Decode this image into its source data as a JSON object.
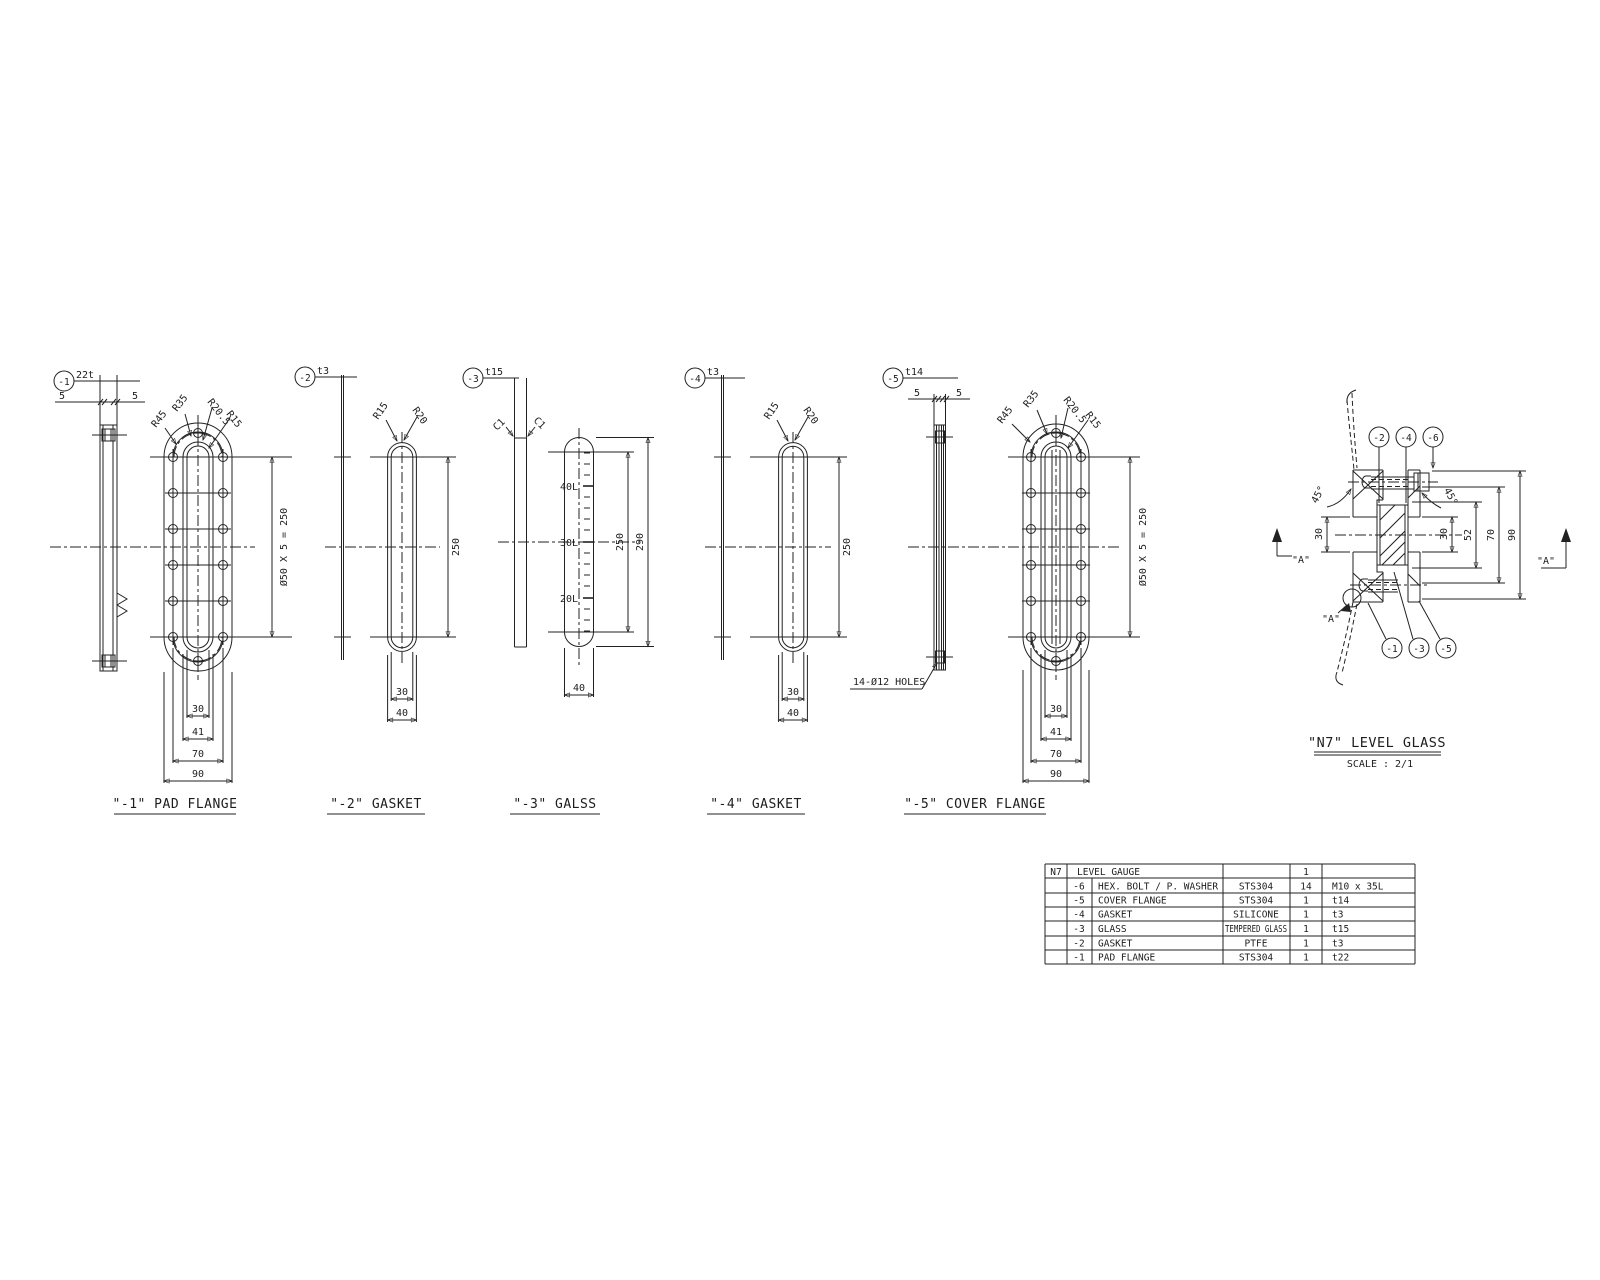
{
  "page": {
    "background": "#ffffff",
    "line_color": "#222222"
  },
  "views": {
    "v1": {
      "balloon": "-1",
      "thickness": "22t",
      "dim5a": "5",
      "dim5b": "5",
      "r45": "R45",
      "r35": "R35",
      "r205": "R20.5",
      "r15": "R15",
      "pitch": "Ø50 X 5 = 250",
      "d30": "30",
      "d41": "41",
      "d70": "70",
      "d90": "90",
      "title": "\"-1\" PAD FLANGE"
    },
    "v2": {
      "balloon": "-2",
      "thickness": "t3",
      "r15": "R15",
      "r20": "R20",
      "d250": "250",
      "d30": "30",
      "d40": "40",
      "title": "\"-2\" GASKET"
    },
    "v3": {
      "balloon": "-3",
      "thickness": "t15",
      "c1_left": "C1",
      "c1_right": "C1",
      "mark40": "40L",
      "mark30": "30L",
      "mark20": "20L",
      "d250": "250",
      "d290": "290",
      "d40": "40",
      "title": "\"-3\" GALSS"
    },
    "v4": {
      "balloon": "-4",
      "thickness": "t3",
      "r15": "R15",
      "r20": "R20",
      "d250": "250",
      "d30": "30",
      "d40": "40",
      "title": "\"-4\" GASKET"
    },
    "v5": {
      "balloon": "-5",
      "thickness": "t14",
      "dim5a": "5",
      "dim5b": "5",
      "r45": "R45",
      "r35": "R35",
      "r205": "R20.5",
      "r15": "R15",
      "pitch": "Ø50 X 5 = 250",
      "holes_note": "14-Ø12 HOLES",
      "d30": "30",
      "d41": "41",
      "d70": "70",
      "d90": "90",
      "title": "\"-5\" COVER FLANGE"
    }
  },
  "assembly": {
    "b2": "-2",
    "b4": "-4",
    "b6": "-6",
    "b1": "-1",
    "b3": "-3",
    "b5": "-5",
    "a45_left": "45°",
    "a45_right": "45°",
    "d30_left": "30",
    "d30_right": "30",
    "d52": "52",
    "d70": "70",
    "d90": "90",
    "a_mark": "\"A\"",
    "title": "\"N7\" LEVEL GLASS",
    "scale": "SCALE : 2/1"
  },
  "bom": {
    "tag": "N7",
    "rows": [
      {
        "no": "",
        "name": "LEVEL GAUGE",
        "material": "",
        "qty": "1",
        "remark": ""
      },
      {
        "no": "-6",
        "name": "HEX. BOLT / P. WASHER",
        "material": "STS304",
        "qty": "14",
        "remark": "M10 x 35L"
      },
      {
        "no": "-5",
        "name": "COVER FLANGE",
        "material": "STS304",
        "qty": "1",
        "remark": "t14"
      },
      {
        "no": "-4",
        "name": "GASKET",
        "material": "SILICONE",
        "qty": "1",
        "remark": "t3"
      },
      {
        "no": "-3",
        "name": "GLASS",
        "material": "TEMPERED GLASS",
        "qty": "1",
        "remark": "t15"
      },
      {
        "no": "-2",
        "name": "GASKET",
        "material": "PTFE",
        "qty": "1",
        "remark": "t3"
      },
      {
        "no": "-1",
        "name": "PAD FLANGE",
        "material": "STS304",
        "qty": "1",
        "remark": "t22"
      }
    ]
  }
}
